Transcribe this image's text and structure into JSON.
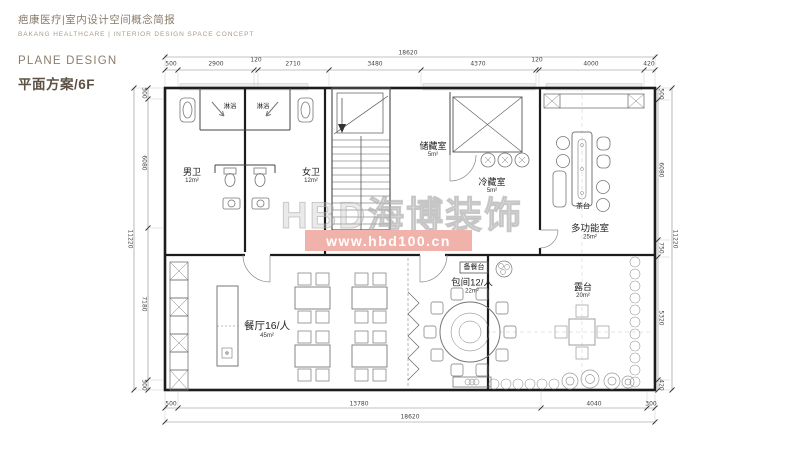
{
  "header": {
    "title_cn": "疤康医疗|室内设计空间概念简报",
    "title_en": "BAKANG HEALTHCARE | INTERIOR DESIGN SPACE CONCEPT"
  },
  "section": {
    "eyebrow": "PLANE DESIGN",
    "title": "平面方案/6F"
  },
  "watermark": {
    "logo_text": "HBD海博装饰",
    "url_text": "www.hbd100.cn",
    "bar_color": "#f0b2aa"
  },
  "rooms": {
    "shower_left": {
      "name": "淋浴"
    },
    "shower_right": {
      "name": "淋浴"
    },
    "mens_wc": {
      "name": "男卫",
      "area": "12m²"
    },
    "womens_wc": {
      "name": "女卫",
      "area": "12m²"
    },
    "storage": {
      "name": "储藏室",
      "area": "5m²"
    },
    "cold_storage": {
      "name": "冷藏室",
      "area": "5m²"
    },
    "tea_table": {
      "name": "茶台"
    },
    "multifunction": {
      "name": "多功能室",
      "area": "25m²"
    },
    "dining": {
      "name": "餐厅16/人",
      "area": "45m²"
    },
    "serving_counter": {
      "name": "备餐台"
    },
    "private_dining": {
      "name": "包间12/人",
      "area": "22m²"
    },
    "terrace": {
      "name": "露台",
      "area": "20m²"
    }
  },
  "dimensions": {
    "top_total": "18620",
    "top_segments": [
      "500",
      "2900",
      "120",
      "2710",
      "3480",
      "4370",
      "120",
      "4000",
      "420"
    ],
    "bottom_segments": [
      "500",
      "13780",
      "4040",
      "300"
    ],
    "bottom_total": "18620",
    "left_total": "11220",
    "left_segments": [
      "500",
      "6080",
      "7180",
      "500"
    ],
    "right_segments": [
      "500",
      "6080",
      "750",
      "5320",
      "420"
    ],
    "right_total": "11220"
  }
}
